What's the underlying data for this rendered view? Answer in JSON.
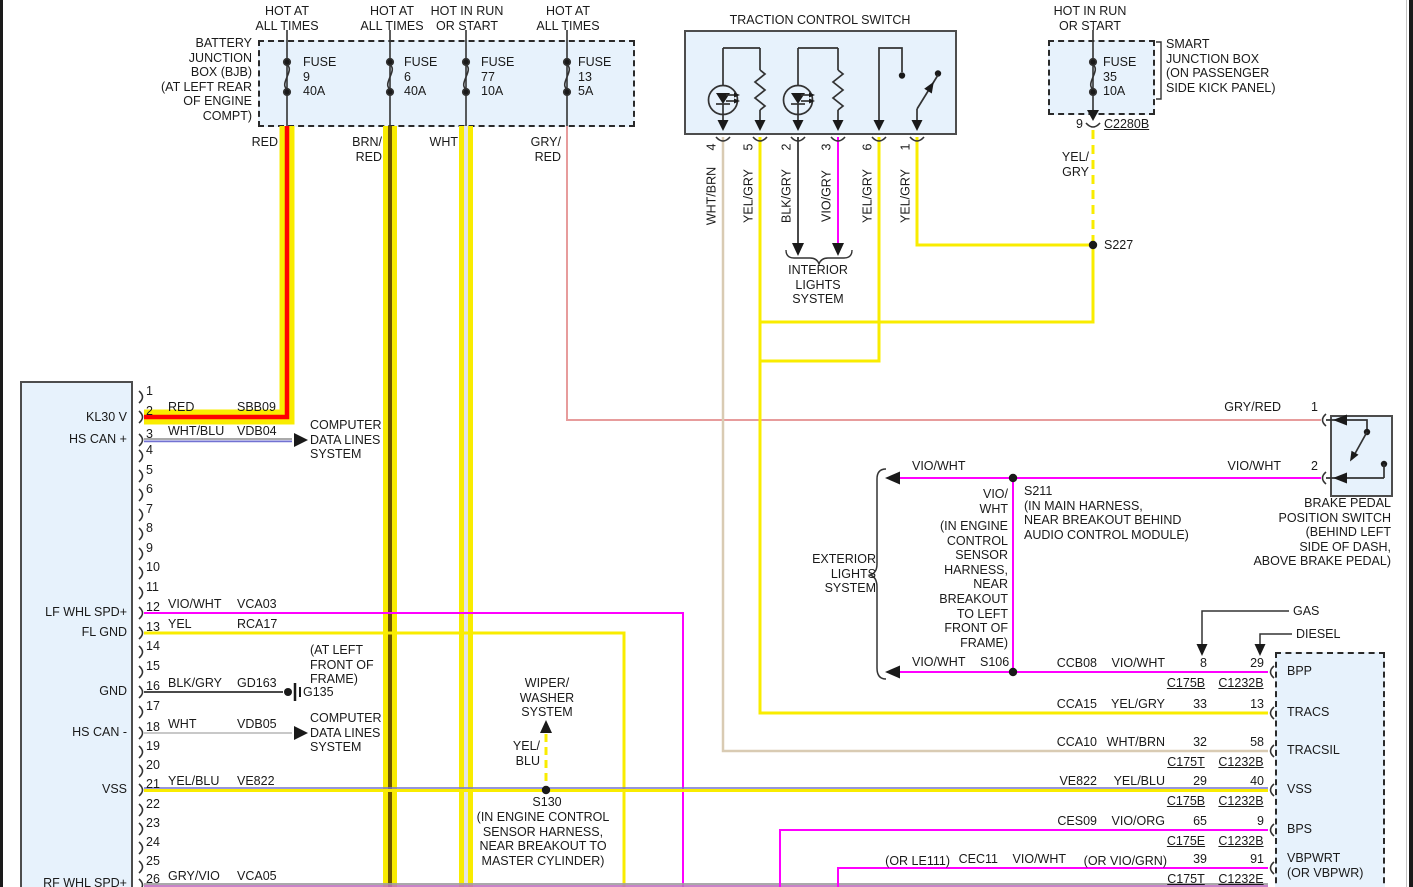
{
  "colors": {
    "box_fill": "#E7F2FC",
    "box_border": "#4D4D4D",
    "black": "#2A2A2A",
    "wire_yellow": "#F9EC00",
    "red": "#FF0000",
    "brown_core": "#6C5700",
    "white_core": "#E4E4E4",
    "pink_gryred": "#E79C9C",
    "magenta": "#FF00FF",
    "tan_whtbrn": "#D9CBB3",
    "dark_blkgry": "#4A4A4A",
    "ltgray_wht": "#C8C8C8",
    "gray_whtblu": "#9E9E9E",
    "blue_stripe": "#7272D2",
    "gray_wire": "#9E9E9E",
    "violet_stripe": "#C070C0"
  },
  "left_connector": {
    "pins": [
      "1",
      "2",
      "3",
      "4",
      "5",
      "6",
      "7",
      "8",
      "9",
      "10",
      "11",
      "12",
      "13",
      "14",
      "15",
      "16",
      "17",
      "18",
      "19",
      "20",
      "21",
      "22",
      "23",
      "24",
      "25",
      "26"
    ]
  },
  "labels": [
    {
      "name": "bjb-title",
      "text": "BATTERY\nJUNCTION\nBOX (BJB)\n(AT LEFT REAR\nOF ENGINE\nCOMPT)",
      "x": 252,
      "y": 36,
      "align": "r"
    },
    {
      "name": "feed-label-1",
      "text": "HOT AT\nALL TIMES",
      "x": 287,
      "y": 4,
      "align": "c"
    },
    {
      "name": "feed-label-2",
      "text": "HOT AT\nALL TIMES",
      "x": 392,
      "y": 4,
      "align": "c"
    },
    {
      "name": "feed-label-3",
      "text": "HOT IN RUN\nOR START",
      "x": 467,
      "y": 4,
      "align": "c"
    },
    {
      "name": "feed-label-4",
      "text": "HOT AT\nALL TIMES",
      "x": 568,
      "y": 4,
      "align": "c"
    },
    {
      "name": "feed-label-5",
      "text": "HOT IN RUN\nOR START",
      "x": 1090,
      "y": 4,
      "align": "c"
    },
    {
      "name": "fuse-9-label",
      "text": "FUSE\n9\n40A",
      "x": 303,
      "y": 55,
      "align": "l"
    },
    {
      "name": "fuse-6-label",
      "text": "FUSE\n6\n40A",
      "x": 404,
      "y": 55,
      "align": "l"
    },
    {
      "name": "fuse-77-label",
      "text": "FUSE\n77\n10A",
      "x": 481,
      "y": 55,
      "align": "l"
    },
    {
      "name": "fuse-13-label",
      "text": "FUSE\n13\n5A",
      "x": 578,
      "y": 55,
      "align": "l"
    },
    {
      "name": "fuse-35-label",
      "text": "FUSE\n35\n10A",
      "x": 1103,
      "y": 55,
      "align": "l"
    },
    {
      "name": "wire-red-label",
      "text": "RED",
      "x": 278,
      "y": 135,
      "align": "r"
    },
    {
      "name": "wire-brnred-label",
      "text": "BRN/\nRED",
      "x": 382,
      "y": 135,
      "align": "r"
    },
    {
      "name": "wire-wht-label",
      "text": "WHT",
      "x": 458,
      "y": 135,
      "align": "r"
    },
    {
      "name": "wire-gryred-label",
      "text": "GRY/\nRED",
      "x": 561,
      "y": 135,
      "align": "r"
    },
    {
      "name": "tcs-title",
      "text": "TRACTION CONTROL SWITCH",
      "x": 820,
      "y": 13,
      "align": "c"
    },
    {
      "name": "tcs-pin-4",
      "text": "4",
      "x": 712,
      "y": 147,
      "align": "c",
      "rot": true
    },
    {
      "name": "tcs-pin-5",
      "text": "5",
      "x": 749,
      "y": 147,
      "align": "c",
      "rot": true
    },
    {
      "name": "tcs-pin-2",
      "text": "2",
      "x": 787,
      "y": 147,
      "align": "c",
      "rot": true
    },
    {
      "name": "tcs-pin-3",
      "text": "3",
      "x": 827,
      "y": 147,
      "align": "c",
      "rot": true
    },
    {
      "name": "tcs-pin-6",
      "text": "6",
      "x": 868,
      "y": 147,
      "align": "c",
      "rot": true
    },
    {
      "name": "tcs-pin-1",
      "text": "1",
      "x": 906,
      "y": 147,
      "align": "c",
      "rot": true
    },
    {
      "name": "tcs-wire-4",
      "text": "WHT/BRN",
      "x": 712,
      "y": 196,
      "align": "c",
      "rot": true
    },
    {
      "name": "tcs-wire-5",
      "text": "YEL/GRY",
      "x": 749,
      "y": 196,
      "align": "c",
      "rot": true
    },
    {
      "name": "tcs-wire-2",
      "text": "BLK/GRY",
      "x": 787,
      "y": 196,
      "align": "c",
      "rot": true
    },
    {
      "name": "tcs-wire-3",
      "text": "VIO/GRY",
      "x": 827,
      "y": 196,
      "align": "c",
      "rot": true
    },
    {
      "name": "tcs-wire-6",
      "text": "YEL/GRY",
      "x": 868,
      "y": 196,
      "align": "c",
      "rot": true
    },
    {
      "name": "tcs-wire-1",
      "text": "YEL/GRY",
      "x": 906,
      "y": 196,
      "align": "c",
      "rot": true
    },
    {
      "name": "interior-lights-system",
      "text": "INTERIOR\nLIGHTS\nSYSTEM",
      "x": 818,
      "y": 263,
      "align": "c"
    },
    {
      "name": "sjb-title",
      "text": "SMART\nJUNCTION BOX\n(ON PASSENGER\nSIDE KICK PANEL)",
      "x": 1166,
      "y": 37,
      "align": "l"
    },
    {
      "name": "sjb-pin-9",
      "text": "9",
      "x": 1083,
      "y": 117,
      "align": "r"
    },
    {
      "name": "conn-c2280b",
      "text": "C2280B",
      "x": 1104,
      "y": 117,
      "align": "l",
      "ul": true
    },
    {
      "name": "wire-yelgry-label",
      "text": "YEL/\nGRY",
      "x": 1089,
      "y": 150,
      "align": "r"
    },
    {
      "name": "splice-s227",
      "text": "S227",
      "x": 1104,
      "y": 238,
      "align": "l"
    },
    {
      "name": "pin-kl30v",
      "text": "KL30 V",
      "x": 127,
      "y": 410,
      "align": "r"
    },
    {
      "name": "pin-hscan-plus",
      "text": "HS CAN +",
      "x": 127,
      "y": 432,
      "align": "r"
    },
    {
      "name": "pin-lfwhlspd",
      "text": "LF WHL SPD+",
      "x": 127,
      "y": 605,
      "align": "r"
    },
    {
      "name": "pin-flgnd",
      "text": "FL GND",
      "x": 127,
      "y": 625,
      "align": "r"
    },
    {
      "name": "pin-gnd",
      "text": "GND",
      "x": 127,
      "y": 684,
      "align": "r"
    },
    {
      "name": "pin-hscan-minus",
      "text": "HS CAN -",
      "x": 127,
      "y": 725,
      "align": "r"
    },
    {
      "name": "pin-vss",
      "text": "VSS",
      "x": 127,
      "y": 782,
      "align": "r"
    },
    {
      "name": "pin-rfwhlspd",
      "text": "RF WHL SPD+",
      "x": 127,
      "y": 876,
      "align": "r"
    },
    {
      "name": "w2-color",
      "text": "RED",
      "x": 168,
      "y": 400,
      "align": "l"
    },
    {
      "name": "w2-circuit",
      "text": "SBB09",
      "x": 237,
      "y": 400,
      "align": "l"
    },
    {
      "name": "w3-color",
      "text": "WHT/BLU",
      "x": 168,
      "y": 424,
      "align": "l"
    },
    {
      "name": "w3-circuit",
      "text": "VDB04",
      "x": 237,
      "y": 424,
      "align": "l"
    },
    {
      "name": "w12-color",
      "text": "VIO/WHT",
      "x": 168,
      "y": 597,
      "align": "l"
    },
    {
      "name": "w12-circuit",
      "text": "VCA03",
      "x": 237,
      "y": 597,
      "align": "l"
    },
    {
      "name": "w13-color",
      "text": "YEL",
      "x": 168,
      "y": 617,
      "align": "l"
    },
    {
      "name": "w13-circuit",
      "text": "RCA17",
      "x": 237,
      "y": 617,
      "align": "l"
    },
    {
      "name": "w16-color",
      "text": "BLK/GRY",
      "x": 168,
      "y": 676,
      "align": "l"
    },
    {
      "name": "w16-circuit",
      "text": "GD163",
      "x": 237,
      "y": 676,
      "align": "l"
    },
    {
      "name": "w18-color",
      "text": "WHT",
      "x": 168,
      "y": 717,
      "align": "l"
    },
    {
      "name": "w18-circuit",
      "text": "VDB05",
      "x": 237,
      "y": 717,
      "align": "l"
    },
    {
      "name": "w21-color",
      "text": "YEL/BLU",
      "x": 168,
      "y": 774,
      "align": "l"
    },
    {
      "name": "w21-circuit",
      "text": "VE822",
      "x": 237,
      "y": 774,
      "align": "l"
    },
    {
      "name": "w26-color",
      "text": "GRY/VIO",
      "x": 168,
      "y": 869,
      "align": "l"
    },
    {
      "name": "w26-circuit",
      "text": "VCA05",
      "x": 237,
      "y": 869,
      "align": "l"
    },
    {
      "name": "computer-data-lines-1",
      "text": "COMPUTER\nDATA LINES\nSYSTEM",
      "x": 310,
      "y": 418,
      "align": "l"
    },
    {
      "name": "g135-location",
      "text": "(AT LEFT\nFRONT OF\nFRAME)",
      "x": 310,
      "y": 643,
      "align": "l"
    },
    {
      "name": "ground-g135",
      "text": "G135",
      "x": 303,
      "y": 685,
      "align": "l"
    },
    {
      "name": "computer-data-lines-2",
      "text": "COMPUTER\nDATA LINES\nSYSTEM",
      "x": 310,
      "y": 711,
      "align": "l"
    },
    {
      "name": "wiper-washer-system",
      "text": "WIPER/\nWASHER\nSYSTEM",
      "x": 547,
      "y": 676,
      "align": "c"
    },
    {
      "name": "wire-yelblu-label",
      "text": "YEL/\nBLU",
      "x": 540,
      "y": 739,
      "align": "r"
    },
    {
      "name": "splice-s130",
      "text": "S130",
      "x": 547,
      "y": 795,
      "align": "c"
    },
    {
      "name": "s130-location",
      "text": "(IN ENGINE CONTROL\nSENSOR HARNESS,\nNEAR BREAKOUT TO\nMASTER CYLINDER)",
      "x": 543,
      "y": 810,
      "align": "c"
    },
    {
      "name": "exterior-lights-system",
      "text": "EXTERIOR\nLIGHTS\nSYSTEM",
      "x": 876,
      "y": 552,
      "align": "r"
    },
    {
      "name": "wire-viowht-upper",
      "text": "VIO/WHT",
      "x": 912,
      "y": 459,
      "align": "l"
    },
    {
      "name": "splice-s211",
      "text": "S211\n(IN MAIN HARNESS,\nNEAR BREAKOUT BEHIND\nAUDIO CONTROL MODULE)",
      "x": 1024,
      "y": 484,
      "align": "l"
    },
    {
      "name": "wire-viowht-vert",
      "text": "VIO/\nWHT",
      "x": 1008,
      "y": 487,
      "align": "r"
    },
    {
      "name": "s106-location",
      "text": "(IN ENGINE\nCONTROL\nSENSOR\nHARNESS,\nNEAR\nBREAKOUT\nTO LEFT\nFRONT OF\nFRAME)",
      "x": 1008,
      "y": 519,
      "align": "r"
    },
    {
      "name": "wire-viowht-lower",
      "text": "VIO/WHT",
      "x": 912,
      "y": 655,
      "align": "l"
    },
    {
      "name": "splice-s106",
      "text": "S106",
      "x": 980,
      "y": 655,
      "align": "l"
    },
    {
      "name": "wire-gryred-bpp",
      "text": "GRY/RED",
      "x": 1281,
      "y": 400,
      "align": "r"
    },
    {
      "name": "bpp-pin-1",
      "text": "1",
      "x": 1318,
      "y": 400,
      "align": "r"
    },
    {
      "name": "wire-viowht-bpp",
      "text": "VIO/WHT",
      "x": 1281,
      "y": 459,
      "align": "r"
    },
    {
      "name": "bpp-pin-2",
      "text": "2",
      "x": 1318,
      "y": 459,
      "align": "r"
    },
    {
      "name": "bpp-title",
      "text": "BRAKE PEDAL\nPOSITION SWITCH\n(BEHIND LEFT\nSIDE OF DASH,\nABOVE BRAKE PEDAL)",
      "x": 1391,
      "y": 496,
      "align": "r"
    },
    {
      "name": "gas-label",
      "text": "GAS",
      "x": 1293,
      "y": 604,
      "align": "l"
    },
    {
      "name": "diesel-label",
      "text": "DIESEL",
      "x": 1296,
      "y": 627,
      "align": "l"
    },
    {
      "name": "row1-circuit",
      "text": "CCB08",
      "x": 1097,
      "y": 656,
      "align": "r"
    },
    {
      "name": "row1-color",
      "text": "VIO/WHT",
      "x": 1165,
      "y": 656,
      "align": "r"
    },
    {
      "name": "row1-gas-pin",
      "text": "8",
      "x": 1207,
      "y": 656,
      "align": "r"
    },
    {
      "name": "row1-diesel-pin",
      "text": "29",
      "x": 1264,
      "y": 656,
      "align": "r"
    },
    {
      "name": "row1-conn-gas",
      "text": "C175B",
      "x": 1186,
      "y": 676,
      "align": "c",
      "ul": true
    },
    {
      "name": "row1-conn-diesel",
      "text": "C1232B",
      "x": 1241,
      "y": 676,
      "align": "c",
      "ul": true
    },
    {
      "name": "row2-circuit",
      "text": "CCA15",
      "x": 1097,
      "y": 697,
      "align": "r"
    },
    {
      "name": "row2-color",
      "text": "YEL/GRY",
      "x": 1165,
      "y": 697,
      "align": "r"
    },
    {
      "name": "row2-gas-pin",
      "text": "33",
      "x": 1207,
      "y": 697,
      "align": "r"
    },
    {
      "name": "row2-diesel-pin",
      "text": "13",
      "x": 1264,
      "y": 697,
      "align": "r"
    },
    {
      "name": "row3-circuit",
      "text": "CCA10",
      "x": 1097,
      "y": 735,
      "align": "r"
    },
    {
      "name": "row3-color",
      "text": "WHT/BRN",
      "x": 1165,
      "y": 735,
      "align": "r"
    },
    {
      "name": "row3-gas-pin",
      "text": "32",
      "x": 1207,
      "y": 735,
      "align": "r"
    },
    {
      "name": "row3-diesel-pin",
      "text": "58",
      "x": 1264,
      "y": 735,
      "align": "r"
    },
    {
      "name": "row3-conn-gas",
      "text": "C175T",
      "x": 1186,
      "y": 755,
      "align": "c",
      "ul": true
    },
    {
      "name": "row3-conn-diesel",
      "text": "C1232B",
      "x": 1241,
      "y": 755,
      "align": "c",
      "ul": true
    },
    {
      "name": "row4-circuit",
      "text": "VE822",
      "x": 1097,
      "y": 774,
      "align": "r"
    },
    {
      "name": "row4-color",
      "text": "YEL/BLU",
      "x": 1165,
      "y": 774,
      "align": "r"
    },
    {
      "name": "row4-gas-pin",
      "text": "29",
      "x": 1207,
      "y": 774,
      "align": "r"
    },
    {
      "name": "row4-diesel-pin",
      "text": "40",
      "x": 1264,
      "y": 774,
      "align": "r"
    },
    {
      "name": "row4-conn-gas",
      "text": "C175B",
      "x": 1186,
      "y": 794,
      "align": "c",
      "ul": true
    },
    {
      "name": "row4-conn-diesel",
      "text": "C1232B",
      "x": 1241,
      "y": 794,
      "align": "c",
      "ul": true
    },
    {
      "name": "row5-circuit",
      "text": "CES09",
      "x": 1097,
      "y": 814,
      "align": "r"
    },
    {
      "name": "row5-color",
      "text": "VIO/ORG",
      "x": 1165,
      "y": 814,
      "align": "r"
    },
    {
      "name": "row5-gas-pin",
      "text": "65",
      "x": 1207,
      "y": 814,
      "align": "r"
    },
    {
      "name": "row5-diesel-pin",
      "text": "9",
      "x": 1264,
      "y": 814,
      "align": "r"
    },
    {
      "name": "row5-conn-gas",
      "text": "C175E",
      "x": 1186,
      "y": 834,
      "align": "c",
      "ul": true
    },
    {
      "name": "row5-conn-diesel",
      "text": "C1232B",
      "x": 1241,
      "y": 834,
      "align": "c",
      "ul": true
    },
    {
      "name": "row6-alt-circuit",
      "text": "(OR LE111)",
      "x": 950,
      "y": 854,
      "align": "r"
    },
    {
      "name": "row6-circuit",
      "text": "CEC11",
      "x": 998,
      "y": 852,
      "align": "r"
    },
    {
      "name": "row6-color",
      "text": "VIO/WHT",
      "x": 1066,
      "y": 852,
      "align": "r"
    },
    {
      "name": "row6-alt-color",
      "text": "(OR VIO/GRN)",
      "x": 1167,
      "y": 854,
      "align": "r"
    },
    {
      "name": "row6-gas-pin",
      "text": "39",
      "x": 1207,
      "y": 852,
      "align": "r"
    },
    {
      "name": "row6-diesel-pin",
      "text": "91",
      "x": 1264,
      "y": 852,
      "align": "r"
    },
    {
      "name": "row6-conn-gas",
      "text": "C175T",
      "x": 1186,
      "y": 872,
      "align": "c",
      "ul": true
    },
    {
      "name": "row6-conn-diesel",
      "text": "C1232E",
      "x": 1241,
      "y": 872,
      "align": "c",
      "ul": true
    },
    {
      "name": "pcm-pin-bpp",
      "text": "BPP",
      "x": 1287,
      "y": 664,
      "align": "l"
    },
    {
      "name": "pcm-pin-tracs",
      "text": "TRACS",
      "x": 1287,
      "y": 705,
      "align": "l"
    },
    {
      "name": "pcm-pin-tracsil",
      "text": "TRACSIL",
      "x": 1287,
      "y": 743,
      "align": "l"
    },
    {
      "name": "pcm-pin-vss",
      "text": "VSS",
      "x": 1287,
      "y": 782,
      "align": "l"
    },
    {
      "name": "pcm-pin-bps",
      "text": "BPS",
      "x": 1287,
      "y": 822,
      "align": "l"
    },
    {
      "name": "pcm-pin-vbpwrt",
      "text": "VBPWRT\n(OR VBPWR)",
      "x": 1287,
      "y": 851,
      "align": "l"
    }
  ]
}
